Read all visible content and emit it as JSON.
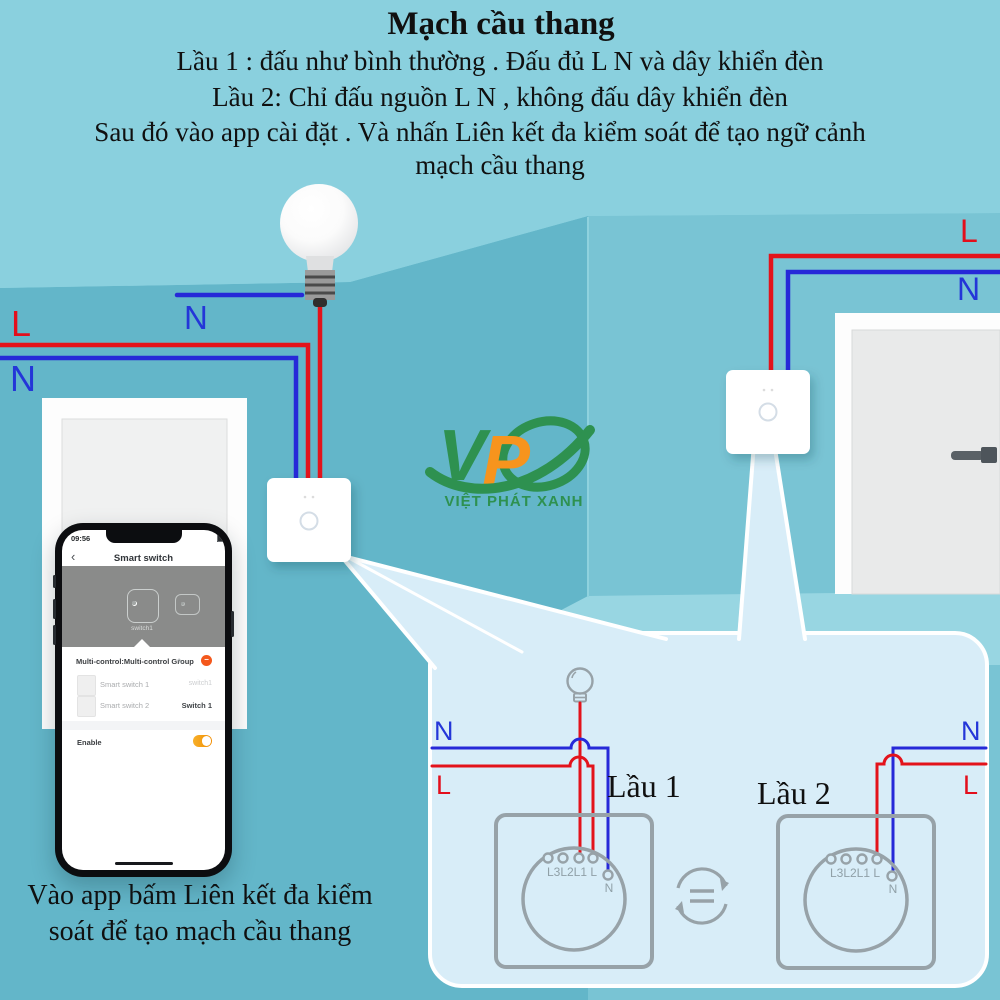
{
  "colors": {
    "ceiling": "#8ad0de",
    "wall_left": "#63b6c9",
    "wall_right": "#79c4d4",
    "floor": "#98d6e2",
    "callout_fill": "#d8edf8",
    "wire_live": "#e3131b",
    "wire_neutral": "#2629d8",
    "outline_gray": "#97a2a8",
    "logo_green": "#2e9150",
    "logo_orange": "#f7941d",
    "toggle_on": "#f28c00",
    "remove_red": "#f4581c"
  },
  "header": {
    "title": "Mạch cầu thang",
    "instructions": [
      "Lầu 1 : đấu như bình thường . Đấu đủ L N và dây khiển đèn",
      "Lầu 2: Chỉ đấu nguồn L N , không đấu dây khiển đèn",
      "Sau đó vào app cài đặt . Và nhấn Liên kết đa kiểm soát để tạo ngữ cảnh",
      "mạch cầu thang"
    ]
  },
  "room": {
    "ceiling_n": "N",
    "left_l": "L",
    "left_n": "N",
    "right_l": "L",
    "right_n": "N"
  },
  "logo": {
    "v": "V",
    "p": "P",
    "subtitle": "VIỆT PHÁT XANH"
  },
  "phone": {
    "time": "09:56",
    "back": "‹",
    "title": "Smart switch",
    "device_label": "switch1",
    "group_header": "Multi-control:Multi-control Group",
    "edit_icon": "✎",
    "remove_icon": "−",
    "rows": [
      {
        "name": "Smart switch 1",
        "value": "switch1"
      },
      {
        "name": "Smart switch 2",
        "value": "Switch 1"
      }
    ],
    "enable_label": "Enable"
  },
  "callout": {
    "floor1": "Lầu 1",
    "floor2": "Lầu 2",
    "left_n": "N",
    "left_l": "L",
    "right_n": "N",
    "right_l": "L",
    "switch1_terminals": "L3L2L1 L",
    "switch1_n": "N",
    "switch2_terminals": "L3L2L1 L",
    "switch2_n": "N"
  },
  "caption": {
    "line1": "Vào app bấm Liên kết đa kiểm",
    "line2": "soát để tạo mạch cầu thang"
  }
}
